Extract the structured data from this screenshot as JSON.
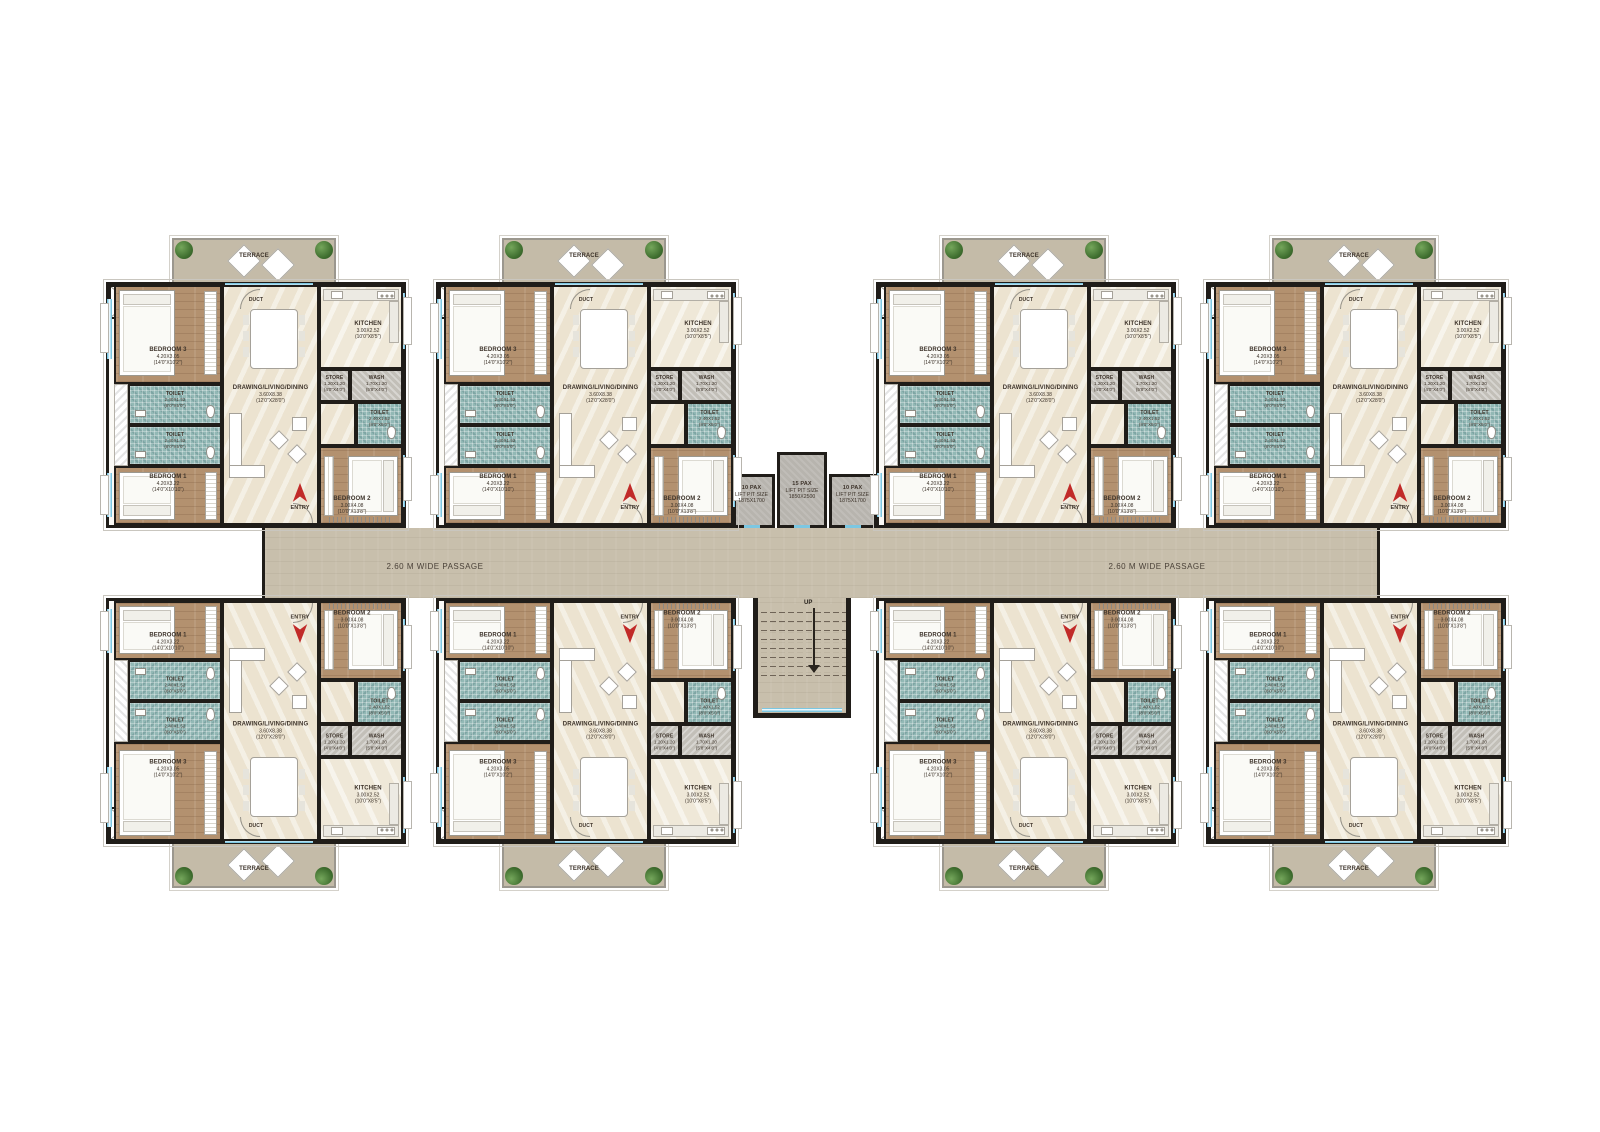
{
  "palette": {
    "wall": "#201d19",
    "wood_floor": "#b3916f",
    "living_floor": "#ece3d0",
    "toilet_floor": "#92b8b5",
    "terrace_floor": "#c4bba8",
    "passage_floor": "#c8bfac",
    "lift_floor": "#b7b4ae",
    "window_blue": "#7cc7e2",
    "entry_arrow_red": "#c12a28"
  },
  "passage": {
    "label": "2.60 M WIDE PASSAGE"
  },
  "core": {
    "lifts": [
      {
        "pax": "10 PAX",
        "label": "LIFT PIT SIZE",
        "size": "1875X1700"
      },
      {
        "pax": "15 PAX",
        "label": "LIFT PIT SIZE",
        "size": "1850X2500"
      },
      {
        "pax": "10 PAX",
        "label": "LIFT PIT SIZE",
        "size": "1875X1700"
      }
    ],
    "stairs": {
      "up_label": "UP"
    }
  },
  "unit": {
    "terrace": {
      "label": "TERRACE"
    },
    "entry": {
      "label": "ENTRY"
    },
    "duct": {
      "label": "DUCT"
    },
    "rooms": {
      "bedroom3": {
        "name": "BEDROOM 3",
        "dim_m": "4.20X3.05",
        "dim_ft": "(14'0\"X10'2\")"
      },
      "toilet_a": {
        "name": "TOILET",
        "dim_m": "2.40X1.52",
        "dim_ft": "(8'0\"X5'0\")"
      },
      "toilet_b": {
        "name": "TOILET",
        "dim_m": "2.40X1.52",
        "dim_ft": "(8'0\"X5'0\")"
      },
      "bedroom1": {
        "name": "BEDROOM 1",
        "dim_m": "4.20X3.22",
        "dim_ft": "(14'0\"X10'10\")"
      },
      "living": {
        "name": "DRAWING/LIVING/DINING",
        "dim_m": "3.60X8.38",
        "dim_ft": "(12'0\"X28'0\")"
      },
      "kitchen": {
        "name": "KITCHEN",
        "dim_m": "3.00X2.52",
        "dim_ft": "(10'0\"X8'5\")"
      },
      "store": {
        "name": "STORE",
        "dim_m": "1.20X1.20",
        "dim_ft": "(4'0\"X4'0\")"
      },
      "wash": {
        "name": "WASH",
        "dim_m": "1.70X1.20",
        "dim_ft": "(5'8\"X4'0\")"
      },
      "toilet_c": {
        "name": "TOILET",
        "dim_m": "2.40X1.52",
        "dim_ft": "(8'0\"X5'0\")"
      },
      "bedroom2": {
        "name": "BEDROOM 2",
        "dim_m": "3.00X4.08",
        "dim_ft": "(10'0\"X13'8\")"
      }
    }
  },
  "units": [
    {
      "id": "top-1",
      "row": "top",
      "col": 1
    },
    {
      "id": "top-2",
      "row": "top",
      "col": 2
    },
    {
      "id": "top-3",
      "row": "top",
      "col": 3
    },
    {
      "id": "top-4",
      "row": "top",
      "col": 4
    },
    {
      "id": "bottom-1",
      "row": "bot",
      "col": 1
    },
    {
      "id": "bottom-2",
      "row": "bot",
      "col": 2
    },
    {
      "id": "bottom-3",
      "row": "bot",
      "col": 3
    },
    {
      "id": "bottom-4",
      "row": "bot",
      "col": 4
    }
  ]
}
